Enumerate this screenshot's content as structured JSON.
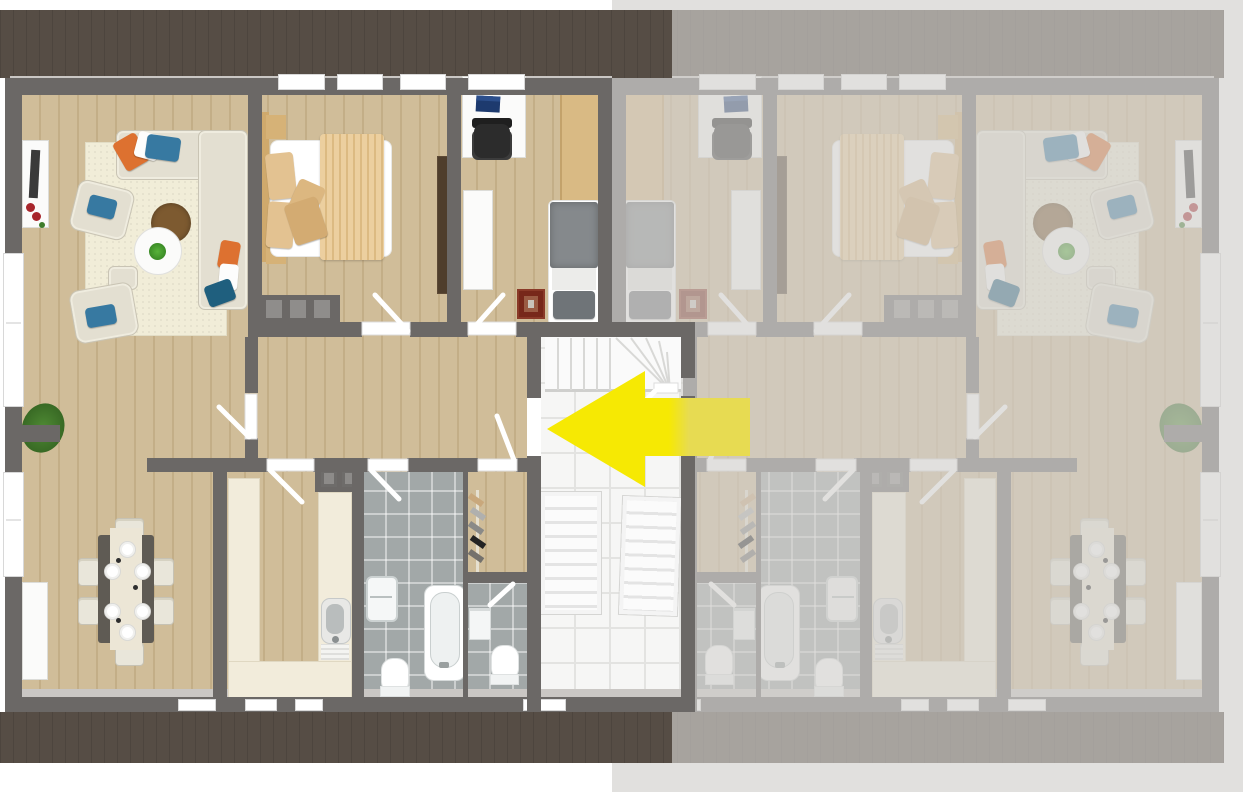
{
  "canvas": {
    "width": 1243,
    "height": 792
  },
  "scene": {
    "description-note": "3D top-down floor plan rendering, two mirrored apartment units; right unit faded; yellow arrow marks entrance from shared staircase into left unit",
    "arrow": {
      "direction": "left",
      "color": "#f6e903",
      "color_washed": "#e7db52"
    }
  },
  "colors": {
    "wood-a": "#d0bd99",
    "wood-b": "#c3ae87",
    "wall": "#6b6866",
    "wall-dark": "#5d5a58",
    "band": "#564d45",
    "tile": "#f6f6f5",
    "tile-grid": "#e3e3e1",
    "bath-tile": "#a2a8a8",
    "cream": "#f2ecdb",
    "rug": "#f1edd8",
    "sofa": "#e3dfd1",
    "orange": "#dd7130",
    "blue": "#3779a1",
    "teal": "#1f5f7e",
    "yellow": "#f6e903",
    "yellow-washed": "#e7db52",
    "wash": "rgba(210,208,205,0.66)"
  }
}
